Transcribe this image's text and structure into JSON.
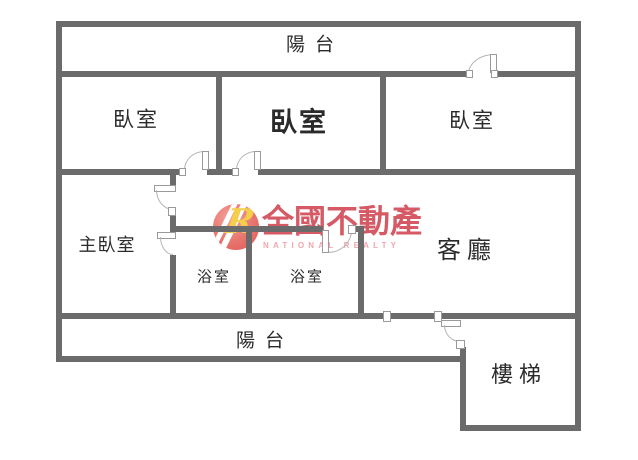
{
  "image": {
    "type": "apartment-floor-plan"
  },
  "colors": {
    "background": "#ffffff",
    "wall": "#6b6b6b",
    "door_line": "#b5b5b5",
    "label_text": "#2b2b2b",
    "brand_red": "#d4545f",
    "brand_pink": "#f0a6ad",
    "badge_fill": "#e2625f",
    "badge_letter": "#f6cf4a"
  },
  "rooms": [
    {
      "id": "balcony-top",
      "label": "陽台"
    },
    {
      "id": "bedroom-left",
      "label": "臥室"
    },
    {
      "id": "bedroom-middle",
      "label": "臥室"
    },
    {
      "id": "bedroom-right",
      "label": "臥室"
    },
    {
      "id": "master-bedroom",
      "label": "主臥室"
    },
    {
      "id": "bathroom-1",
      "label": "浴室"
    },
    {
      "id": "bathroom-2",
      "label": "浴室"
    },
    {
      "id": "living-room",
      "label": "客廳"
    },
    {
      "id": "balcony-bottom",
      "label": "陽台"
    },
    {
      "id": "stairs",
      "label": "樓梯"
    }
  ],
  "watermark": {
    "logo_letter": "R",
    "brand": "全國不動產",
    "brand_en": "NATIONAL REALTY"
  }
}
